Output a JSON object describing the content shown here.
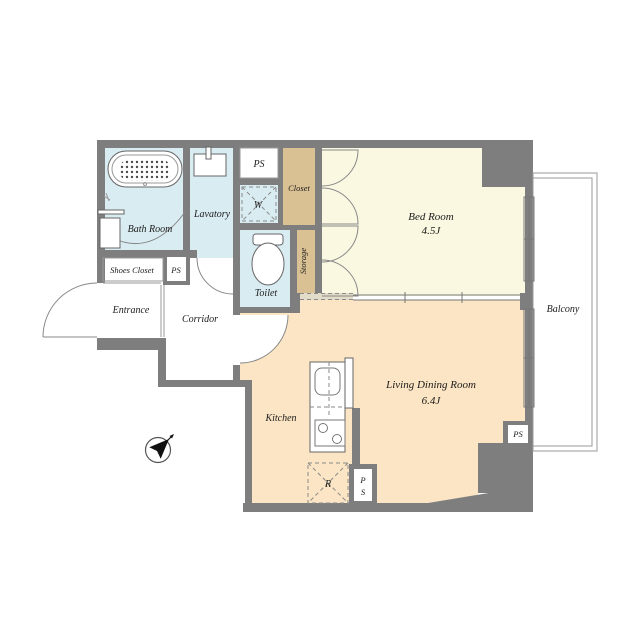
{
  "plan": {
    "rooms": {
      "bed_room": {
        "name": "Bed Room",
        "size": "4.5J"
      },
      "living_dining": {
        "name": "Living Dining Room",
        "size": "6.4J"
      },
      "kitchen": {
        "name": "Kitchen"
      },
      "bath": {
        "name": "Bath Room"
      },
      "lavatory": {
        "name": "Lavatory"
      },
      "toilet": {
        "name": "Toilet"
      },
      "corridor": {
        "name": "Corridor"
      },
      "entrance": {
        "name": "Entrance"
      },
      "shoes_closet": {
        "name": "Shoes Closet"
      },
      "closet": {
        "name": "Closet"
      },
      "storage": {
        "name": "Storage"
      },
      "balcony": {
        "name": "Balcony"
      }
    },
    "labels": {
      "pipe_space": "PS",
      "pipe_space_p": "P",
      "pipe_space_s": "S",
      "washer": "W",
      "refrigerator": "R"
    },
    "icons": {
      "compass": "north-arrow"
    },
    "colors": {
      "wall": "#7e7e7e",
      "water_rooms": "#d9ecf2",
      "storage_rooms": "#d9c193",
      "bedroom": "#faf8e1",
      "living": "#fbe5c4",
      "strip": "#e3dcc8",
      "line": "#777777",
      "text": "#1c1c1c"
    }
  }
}
